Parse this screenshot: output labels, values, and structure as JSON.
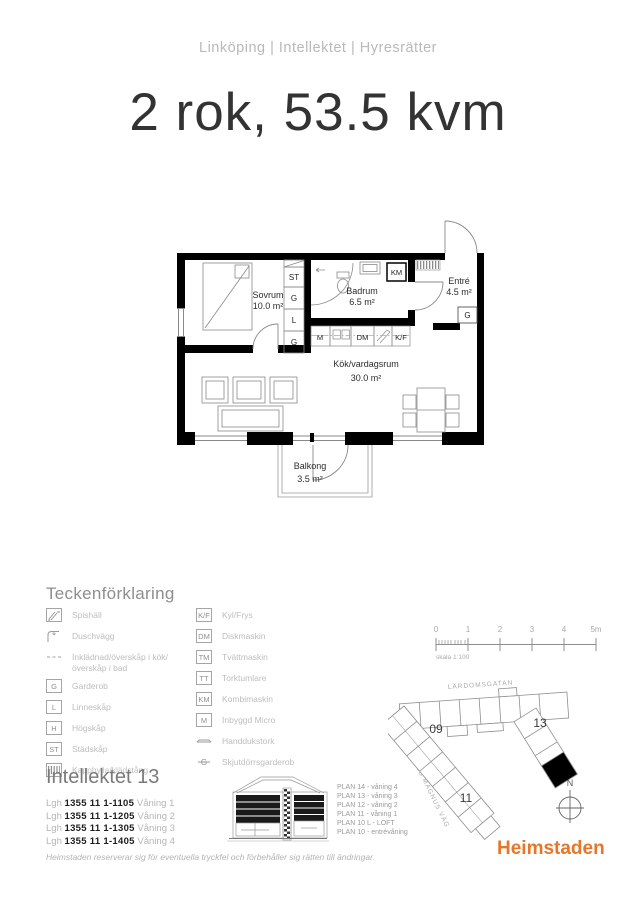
{
  "header": {
    "breadcrumb": "Linköping | Intellektet | Hyresrätter",
    "title": "2 rok, 53.5 kvm"
  },
  "floorplan": {
    "rooms": [
      {
        "name": "Sovrum",
        "area": "10.0 m²"
      },
      {
        "name": "Badrum",
        "area": "6.5 m²"
      },
      {
        "name": "Entré",
        "area": "4.5 m²"
      },
      {
        "name": "Kök/vardagsrum",
        "area": "30.0 m²"
      },
      {
        "name": "Balkong",
        "area": "3.5 m²"
      }
    ],
    "fixtures": {
      "st": "ST",
      "g": "G",
      "l": "L",
      "km": "KM",
      "m": "M",
      "dm": "DM",
      "kf": "K/F"
    }
  },
  "legend": {
    "title": "Teckenförklaring",
    "left": [
      {
        "icon": "stove-icon",
        "label": "Spishäll"
      },
      {
        "icon": "shower-icon",
        "label": "Duschvägg"
      },
      {
        "icon": "dashed-line-icon",
        "label": "Inklädnad/överskåp i kök/överskåp i bad"
      },
      {
        "icon_text": "G",
        "label": "Garderob"
      },
      {
        "icon_text": "L",
        "label": "Linneskåp"
      },
      {
        "icon_text": "H",
        "label": "Högskåp"
      },
      {
        "icon_text": "ST",
        "label": "Städskåp"
      },
      {
        "icon": "hatch-icon",
        "label": "Kapphylla/klädstång"
      }
    ],
    "right": [
      {
        "icon_text": "K/F",
        "label": "Kyl/Frys"
      },
      {
        "icon_text": "DM",
        "label": "Diskmaskin"
      },
      {
        "icon_text": "TM",
        "label": "Tvättmaskin"
      },
      {
        "icon_text": "TT",
        "label": "Torktumlare"
      },
      {
        "icon_text": "KM",
        "label": "Kombimaskin"
      },
      {
        "icon_text": "M",
        "label": "Inbyggd Micro"
      },
      {
        "icon": "towel-rail-icon",
        "label": "Handdukstork"
      },
      {
        "icon_text": "G",
        "label": "Skjutdörrsgarderob"
      }
    ]
  },
  "scalebar": {
    "ticks": [
      "0",
      "1",
      "2",
      "3",
      "4",
      "5m"
    ],
    "label": "skala 1:100"
  },
  "siteplan": {
    "street_top": "LÄRDOMSGATAN",
    "street_left": "JOHANNES MAGNUS VÄG",
    "numbers": [
      "09",
      "13",
      "11"
    ],
    "compass": "N"
  },
  "building": {
    "title": "Intellektet 13",
    "apartments": [
      {
        "prefix": "Lgh",
        "number": "1355 11 1-1105",
        "floor": "Våning 1"
      },
      {
        "prefix": "Lgh",
        "number": "1355 11 1-1205",
        "floor": "Våning 2"
      },
      {
        "prefix": "Lgh",
        "number": "1355 11 1-1305",
        "floor": "Våning 3"
      },
      {
        "prefix": "Lgh",
        "number": "1355 11 1-1405",
        "floor": "Våning 4"
      }
    ],
    "plans": [
      "PLAN 14 - våning 4",
      "PLAN 13 - våning 3",
      "PLAN 12 - våning 2",
      "PLAN 11 - våning 1",
      "PLAN 10 L - LOFT",
      "PLAN 10 - entrévåning"
    ]
  },
  "footer": {
    "disclaimer": "Heimstaden reserverar sig för eventuella tryckfel och förbehåller sig rätten till ändringar.",
    "logo": "Heimstaden"
  },
  "colors": {
    "brand_orange": "#e87629"
  }
}
